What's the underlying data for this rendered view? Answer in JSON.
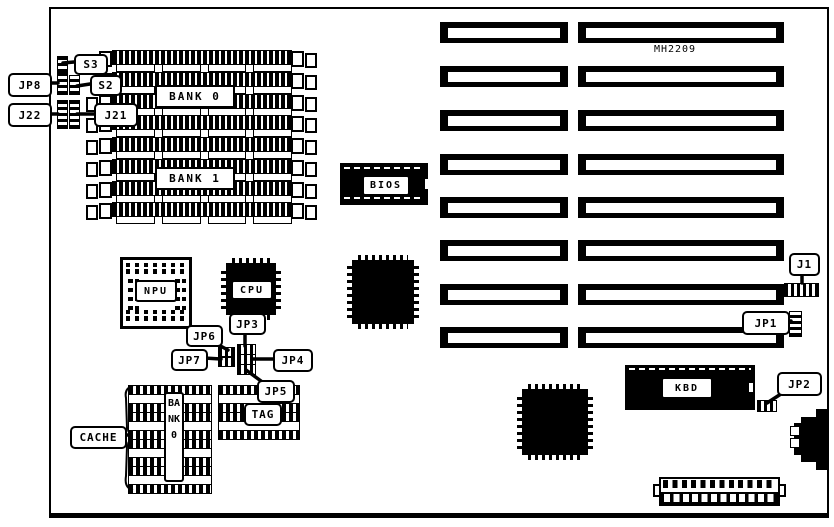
{
  "diagram": {
    "part_number": "MH2209",
    "memory": {
      "bank0": "BANK 0",
      "bank1": "BANK 1"
    },
    "chips": {
      "bios": "BIOS",
      "cpu": "CPU",
      "npu": "NPU",
      "kbd": "KBD"
    },
    "cache": {
      "label": "CACHE",
      "bank_vertical": "BANK0",
      "tag": "TAG"
    },
    "callouts": {
      "s3": "S3",
      "s2": "S2",
      "jp8": "JP8",
      "j22": "J22",
      "j21": "J21",
      "jp6": "JP6",
      "jp3": "JP3",
      "jp7": "JP7",
      "jp4": "JP4",
      "jp5": "JP5",
      "j1": "J1",
      "jp1": "JP1",
      "jp2": "JP2"
    },
    "colors": {
      "ink": "#000000",
      "background": "#ffffff"
    }
  }
}
